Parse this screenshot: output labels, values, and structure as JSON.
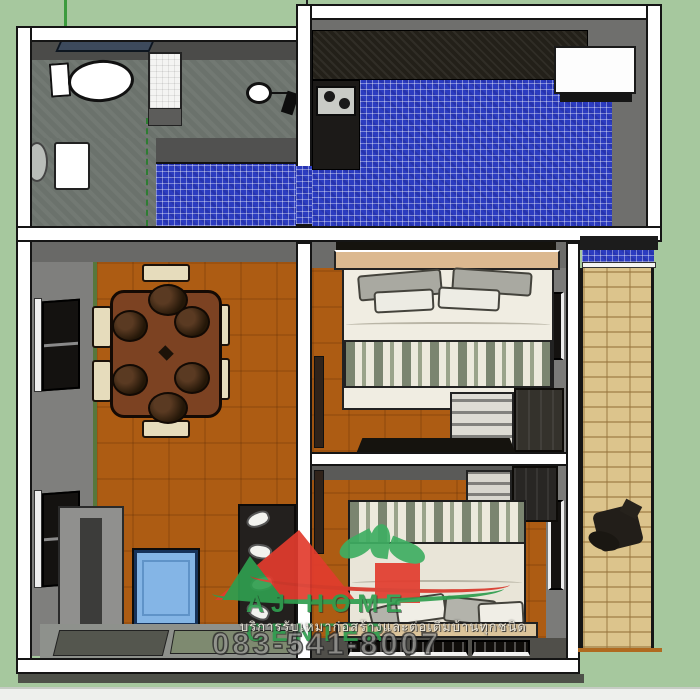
{
  "meta": {
    "description": "3D top-down architectural floor plan rendering (SketchUp style) of a single-storey house",
    "canvas": {
      "width": 700,
      "height": 700
    }
  },
  "watermark": {
    "brand": "AJ HOME CENTER",
    "tagline_thai": "บริการรับเหมาก่อสร้างและต่อเติมบ้านทุกชนิด",
    "phone": "083-541-8007",
    "brand_color": "#2f9e4f",
    "logo_red": "#e23c2e",
    "logo_green": "#3fae62"
  },
  "palette": {
    "grass": "#a6c89e",
    "wall_white": "#ffffff",
    "wall_gray": "#6f6f6d",
    "floor_wood": "#ad5c13",
    "floor_tile_blue": "#2c3cc0",
    "floor_bathroom": "#6b726c",
    "counter_black": "#232019",
    "walkway_brick": "#dcc48c",
    "bed_linen": "#f0ede2",
    "blanket_stripe_green": "#7b8570",
    "coffee_table_blue": "#84b5e6",
    "dining_table_wood": "#7c4222"
  },
  "rooms": [
    {
      "name": "bathroom"
    },
    {
      "name": "kitchen"
    },
    {
      "name": "dining-living-room"
    },
    {
      "name": "bedroom-1"
    },
    {
      "name": "bedroom-2"
    },
    {
      "name": "side-walkway"
    },
    {
      "name": "front-porch"
    }
  ]
}
